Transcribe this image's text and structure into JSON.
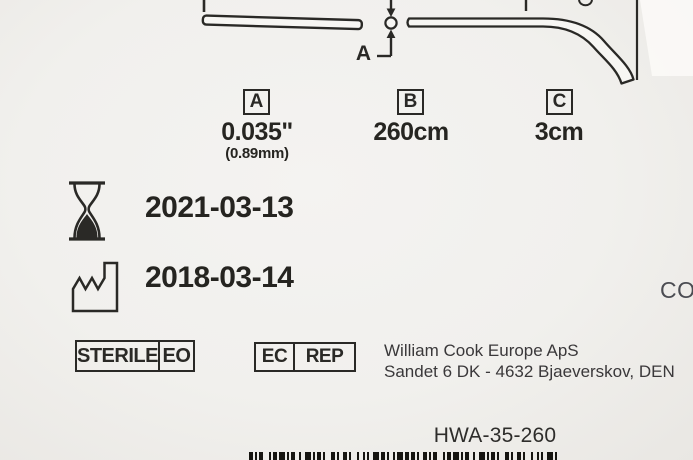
{
  "diagram": {
    "pointer_label": "A",
    "dimensions": [
      {
        "key": "A",
        "value": "0.035\"",
        "value_secondary": "(0.89mm)"
      },
      {
        "key": "B",
        "value": "260cm"
      },
      {
        "key": "C",
        "value": "3cm"
      }
    ]
  },
  "dates": {
    "expiry": "2021-03-13",
    "manufacture": "2018-03-14"
  },
  "symbols": {
    "sterile": {
      "label": "STERILE",
      "method": "EO"
    },
    "ec_rep": {
      "ec": "EC",
      "rep": "REP"
    }
  },
  "manufacturer": {
    "name": "William Cook Europe ApS",
    "address_line": "Sandet 6 DK - 4632 Bjaeverskov, DEN"
  },
  "partial_right_text": "CO",
  "product": {
    "reference": "HWA-35-260"
  },
  "barcode": {
    "pattern": "21112311213111221231112113211221131211123121121131212112",
    "unit": 2,
    "color": "#161511"
  },
  "colors": {
    "ink": "#2a2926",
    "background": "#f2f1ee"
  }
}
